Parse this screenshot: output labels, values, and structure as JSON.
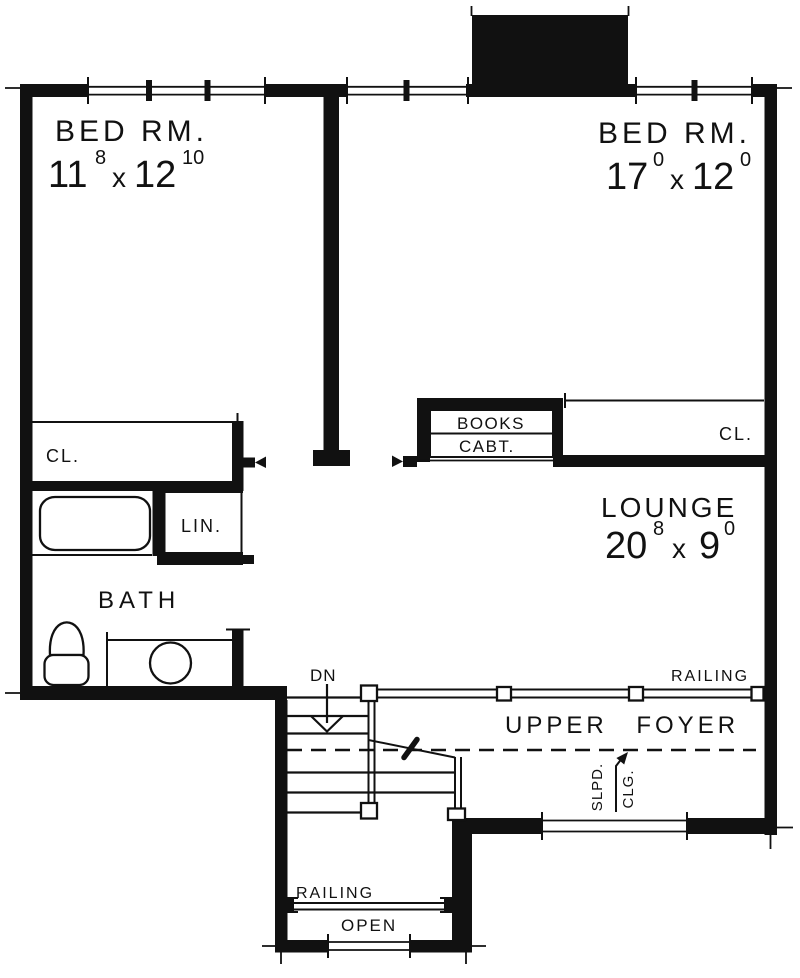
{
  "colors": {
    "ink": "#111111",
    "bg": "#ffffff"
  },
  "rooms": {
    "bed1": {
      "label": "BED RM.",
      "dim": {
        "a": "11",
        "a_sup": "8",
        "sep": "x",
        "b": "12",
        "b_sup": "10"
      }
    },
    "bed2": {
      "label": "BED RM.",
      "dim": {
        "a": "17",
        "a_sup": "0",
        "sep": "x",
        "b": "12",
        "b_sup": "0"
      }
    },
    "lounge": {
      "label": "LOUNGE",
      "dim": {
        "a": "20",
        "a_sup": "8",
        "sep": "x",
        "b": "9",
        "b_sup": "0"
      }
    },
    "bath": {
      "label": "BATH"
    },
    "upper_foyer": {
      "label": "UPPER  FOYER"
    }
  },
  "labels": {
    "closet_left": "CL.",
    "closet_right": "CL.",
    "linen": "LIN.",
    "books": "BOOKS",
    "cabinet": "CABT.",
    "down": "DN",
    "railing_upper": "RAILING",
    "railing_lower": "RAILING",
    "open": "OPEN",
    "sloped_ceiling_line1": "SLPD.",
    "sloped_ceiling_line2": "CLG."
  }
}
